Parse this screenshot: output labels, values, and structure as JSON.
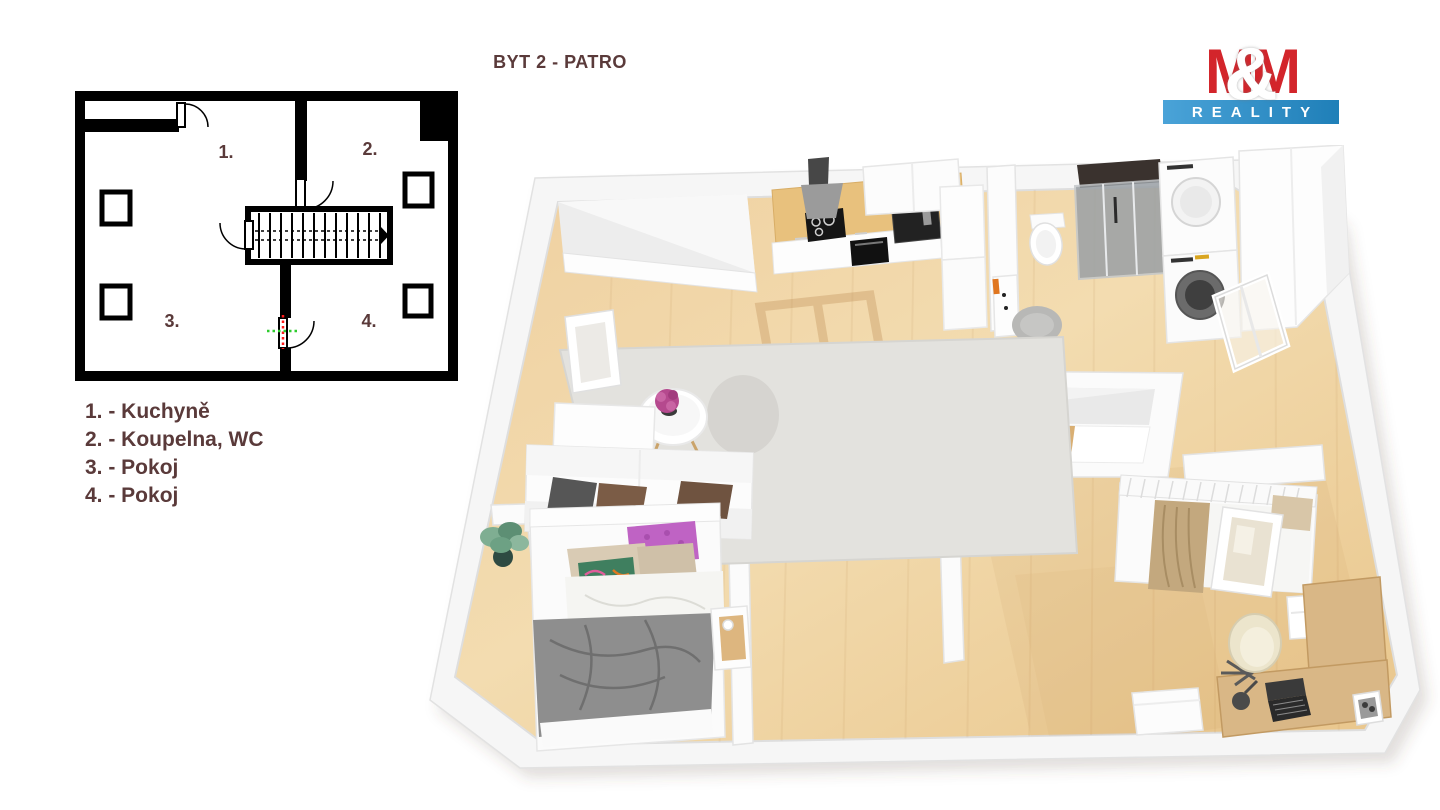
{
  "title": "BYT 2 - PATRO",
  "logo": {
    "m_left": "M",
    "amp": "&",
    "m_right": "M",
    "bottom": "REALITY"
  },
  "plan2d": {
    "rooms": [
      {
        "num": "1."
      },
      {
        "num": "2."
      },
      {
        "num": "3."
      },
      {
        "num": "4."
      }
    ]
  },
  "legend": {
    "items": [
      {
        "label": "1. - Kuchyně"
      },
      {
        "label": "2. - Koupelna, WC"
      },
      {
        "label": "3. - Pokoj"
      },
      {
        "label": "4. - Pokoj"
      }
    ]
  },
  "colors": {
    "text_brown": "#5a3a3a",
    "logo_red": "#d3252b",
    "logo_blue": "#2f8dc3",
    "plan_wall_black": "#000000",
    "marker_red": "#ff1a1a",
    "marker_green": "#2ecc2e",
    "floor_wood_light": "#f3dcb0",
    "floor_wood_dark": "#e9c68c",
    "rug_gray": "#e3e2de",
    "wall_white": "#fbfbfb",
    "blanket_gray": "#8e8e8e",
    "blanket_tan": "#c3a87e",
    "pillow_purple": "#bf63c4",
    "flower_magenta": "#b5498e",
    "counter_wood": "#e8c17d",
    "desk_wood": "#d9b786"
  }
}
